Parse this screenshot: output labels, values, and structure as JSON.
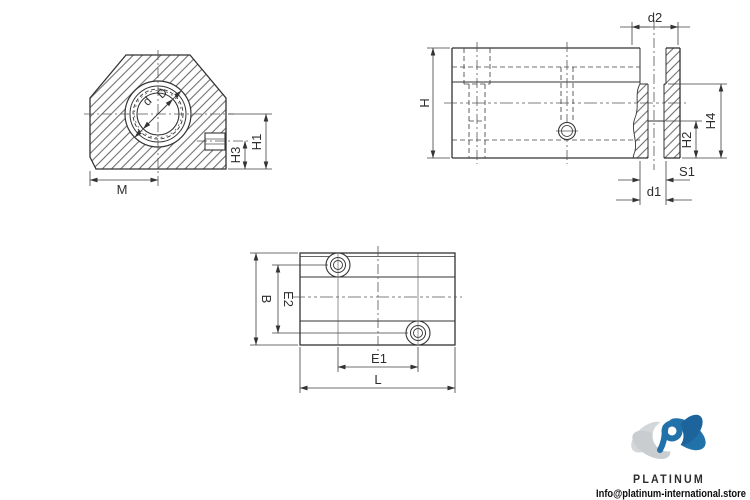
{
  "drawing": {
    "front_view": {
      "labels": {
        "d": "d",
        "D": "D",
        "h1": "H1",
        "h3": "H3",
        "m": "M"
      }
    },
    "side_view": {
      "labels": {
        "d2": "d2",
        "h": "H",
        "h2": "H2",
        "h4": "H4",
        "s1": "S1",
        "d1": "d1"
      }
    },
    "top_view": {
      "labels": {
        "b": "B",
        "e2": "E2",
        "e1": "E1",
        "l": "L"
      }
    }
  },
  "branding": {
    "name": "PLATINUM",
    "email": "Info@platinum-international.store"
  },
  "colors": {
    "line": "#333333",
    "dim_line": "#3f3f3f",
    "center_line": "#555555",
    "logo_blue": "#2272aa",
    "logo_blue_dark": "#1d639c",
    "logo_gray": "#d4d7d9",
    "logo_gray_dark": "#c9cdcf"
  }
}
